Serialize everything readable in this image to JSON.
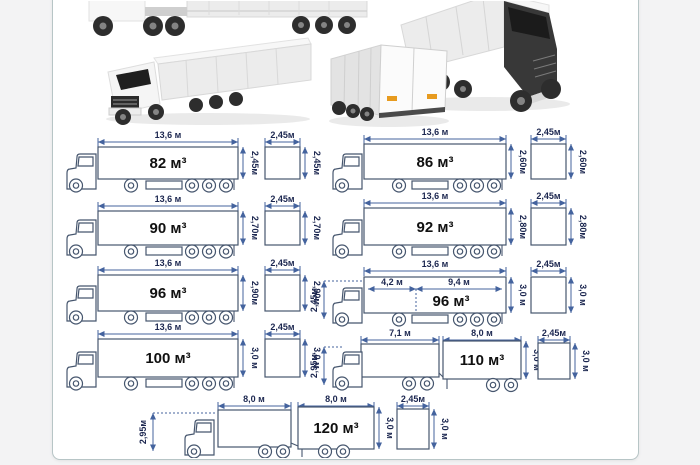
{
  "canvas": {
    "background": "#f3f3f4",
    "card_background": "#ffffff",
    "card_border": "#b7c5c6",
    "dimension_color": "#44639e",
    "label_color": "#1c2750",
    "outline_color": "#46566e"
  },
  "photos": {
    "top_left": "side-view-semitrailer-photo",
    "top_right": "front-quarter-truck-photo",
    "mid_left": "front-quarter-semitrailer-photo",
    "mid_right": "rear-quarter-semitrailer-photo"
  },
  "diagrams": {
    "d82": {
      "length": "13,6 м",
      "volume": "82 м³",
      "height": "2,45м",
      "sq_w": "2,45м",
      "sq_h": "2,45м"
    },
    "d86": {
      "length": "13,6 м",
      "volume": "86 м³",
      "height": "2,60м",
      "sq_w": "2,45м",
      "sq_h": "2,60м"
    },
    "d90": {
      "length": "13,6 м",
      "volume": "90 м³",
      "height": "2,70м",
      "sq_w": "2,45м",
      "sq_h": "2,70м"
    },
    "d92": {
      "length": "13,6 м",
      "volume": "92 м³",
      "height": "2,80м",
      "sq_w": "2,45м",
      "sq_h": "2,80м"
    },
    "d96": {
      "length": "13,6 м",
      "volume": "96 м³",
      "height": "2,90м",
      "sq_w": "2,45м",
      "sq_h": "2,90м"
    },
    "d96j": {
      "length": "13,6 м",
      "front": "4,2 м",
      "rear": "9,4 м",
      "volume": "96 м³",
      "cab_h": "2,45м",
      "height": "3,0 м",
      "sq_w": "2,45м",
      "sq_h": "3,0 м"
    },
    "d100": {
      "length": "13,6 м",
      "volume": "100 м³",
      "height": "3,0 м",
      "sq_w": "2,45м",
      "sq_h": "3,0 м"
    },
    "d110": {
      "front": "7,1 м",
      "rear": "8,0 м",
      "volume": "110 м³",
      "cab_h": "2,95м",
      "height": "3,0 м",
      "sq_w": "2,45м",
      "sq_h": "3,0 м"
    },
    "d120": {
      "front": "8,0 м",
      "rear": "8,0 м",
      "volume": "120 м³",
      "cab_h": "2,95м",
      "height": "3,0 м",
      "sq_w": "2,45м",
      "sq_h": "3,0 м"
    }
  }
}
